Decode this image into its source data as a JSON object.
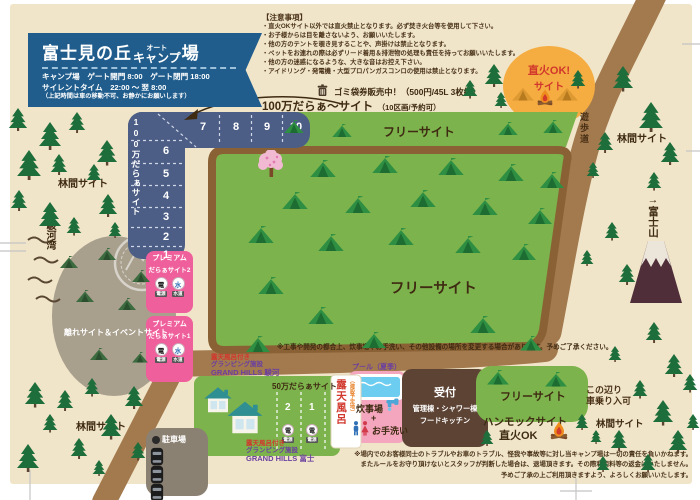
{
  "header": {
    "title_1": "富士見の丘",
    "title_2": "オート",
    "title_3": "キャンプ",
    "title_4": "場",
    "line1": "キャンプ場　ゲート開門 8:00　ゲート閉門 18:00",
    "line2": "サイレントタイム　22:00 ～ 翌 8:00",
    "line3": "（上記時間は車の移動不可、お静かにお願いします）"
  },
  "notice": {
    "heading": "【注意事項】",
    "items": [
      "・直火OKサイト以外では直火禁止となります。必ず焚き火台等を使用して下さい。",
      "・お子様からは目を離さないよう、お願いいたします。",
      "・他の方のテントを覗き見することや、声掛けは禁止となります。",
      "・ペットをお連れの際は必ずリード着用＆排泄物の処理も責任を持ってお願いいたします。",
      "・他の方の迷惑になるような、大きな音はお控え下さい。",
      "・アイドリング・発電機・大型プロパンガスコンロの使用は禁止となります。"
    ]
  },
  "garbage_sale": "ゴミ袋券販売中！（500円/45L 3枚組）",
  "million_site": {
    "label": "100万だらぁ～サイト",
    "note": "（10区画/予約可）",
    "strip_label": "100万だらぁサイト",
    "numbers_top": [
      "7",
      "8",
      "9",
      "10"
    ],
    "numbers_side": [
      "6",
      "5",
      "4",
      "3",
      "2",
      "1"
    ]
  },
  "labels": {
    "free_site": "フリーサイト",
    "rinkan_site": "林間サイト",
    "yuhodo": "遊歩道",
    "suruga_arrow": "←",
    "suruga": "駿河湾",
    "fuji": "→富士山",
    "hanare": "離れサイト＆イベントサイト",
    "parking": "駐車場"
  },
  "jikabi_site": {
    "line1": "直火OK!",
    "line2": "サイト"
  },
  "premium": {
    "title": "プレミアム",
    "site2": "だらぁサイト2",
    "site1": "だらぁサイト1",
    "power": "電源",
    "water": "水道",
    "power_kanji": "電",
    "water_kanji": "水"
  },
  "field_note": "※工事や開発の都合上、炊事場やお手洗い、その他設備の場所を変更する場合があります。予めご了承ください。",
  "glamping_suruga": {
    "l1": "露天風呂付き",
    "l2": "グランピング施設",
    "l3": "GRAND HILLS 駿河"
  },
  "glamping_fuji": {
    "l1": "露天風呂付き",
    "l2": "グランピング施設",
    "l3": "GRAND HILLS 富士"
  },
  "fifty_site": {
    "label": "50万だらぁサイト",
    "plot2": "2",
    "plot1": "1",
    "power": "電源",
    "power_kanji": "電"
  },
  "rotenburo": {
    "label": "露天風呂",
    "note": "（建設予定地）"
  },
  "pool_label": "プール（夏季）",
  "cooking": {
    "l1": "炊事場",
    "plus": "+",
    "l2": "お手洗い"
  },
  "reception": {
    "l1": "受付",
    "l2": "管理棟・シャワー棟",
    "l3": "フードキッチン"
  },
  "hammock": {
    "l1": "ハンモックサイト",
    "l2": "直火OK"
  },
  "car_entry": {
    "l1": "この辺り",
    "l2": "車乗り入可"
  },
  "disclaimer": [
    "※場内でのお客様同士のトラブルやお車のトラブル、怪我や事故等に対し当キャンプ場は一切の責任を負いかねます。",
    "またルールをお守り頂けないとスタッフが判断した場合は、退場頂きます。その際利用料等の返金はいたしません。",
    "予めご了承の上ご利用頂きますよう、よろしくお願いいたします。"
  ],
  "colors": {
    "paper": "#f0e5c9",
    "header_blue": "#205d8c",
    "strip_blue": "#4d5e86",
    "field_green": "#7cb34c",
    "fence_brown": "#8a6134",
    "path_brown": "#a3794e",
    "premium_pink": "#ef5f9b",
    "jikabi_yellow": "#f5ac40",
    "reception_brown": "#5c4334",
    "accent_red": "#d1372c"
  },
  "decor": {
    "pine": [
      [
        8,
        108,
        20
      ],
      [
        38,
        122,
        24
      ],
      [
        68,
        112,
        18
      ],
      [
        96,
        140,
        22
      ],
      [
        16,
        150,
        26
      ],
      [
        50,
        154,
        18
      ],
      [
        86,
        164,
        16
      ],
      [
        10,
        190,
        18
      ],
      [
        38,
        202,
        24
      ],
      [
        98,
        194,
        20
      ],
      [
        66,
        217,
        16
      ],
      [
        108,
        222,
        14
      ],
      [
        24,
        382,
        22
      ],
      [
        56,
        390,
        18
      ],
      [
        84,
        378,
        16
      ],
      [
        124,
        386,
        20
      ],
      [
        42,
        414,
        16
      ],
      [
        100,
        414,
        22
      ],
      [
        70,
        438,
        18
      ],
      [
        16,
        444,
        24
      ],
      [
        130,
        442,
        16
      ],
      [
        92,
        460,
        14
      ],
      [
        462,
        80,
        16
      ],
      [
        484,
        64,
        20
      ],
      [
        494,
        92,
        14
      ],
      [
        612,
        66,
        22
      ],
      [
        638,
        102,
        26
      ],
      [
        596,
        132,
        18
      ],
      [
        660,
        142,
        20
      ],
      [
        586,
        162,
        14
      ],
      [
        646,
        172,
        16
      ],
      [
        604,
        222,
        16
      ],
      [
        580,
        250,
        14
      ],
      [
        618,
        264,
        18
      ],
      [
        645,
        322,
        18
      ],
      [
        608,
        346,
        14
      ],
      [
        664,
        354,
        20
      ],
      [
        632,
        380,
        16
      ],
      [
        652,
        400,
        22
      ],
      [
        682,
        374,
        16
      ],
      [
        610,
        430,
        18
      ],
      [
        668,
        430,
        20
      ],
      [
        596,
        456,
        14
      ],
      [
        640,
        454,
        16
      ],
      [
        686,
        414,
        14
      ],
      [
        575,
        414,
        14
      ],
      [
        590,
        430,
        12
      ],
      [
        480,
        430,
        14
      ],
      [
        570,
        70,
        16
      ]
    ],
    "tent": [
      [
        310,
        160,
        26
      ],
      [
        372,
        156,
        26
      ],
      [
        438,
        158,
        26
      ],
      [
        498,
        164,
        26
      ],
      [
        540,
        172,
        24
      ],
      [
        282,
        192,
        26
      ],
      [
        345,
        196,
        26
      ],
      [
        410,
        190,
        26
      ],
      [
        472,
        198,
        26
      ],
      [
        528,
        208,
        24
      ],
      [
        248,
        226,
        26
      ],
      [
        318,
        234,
        26
      ],
      [
        388,
        228,
        26
      ],
      [
        455,
        236,
        26
      ],
      [
        512,
        244,
        24
      ],
      [
        258,
        277,
        26
      ],
      [
        308,
        307,
        26
      ],
      [
        362,
        332,
        24
      ],
      [
        470,
        316,
        26
      ],
      [
        520,
        336,
        22
      ],
      [
        246,
        336,
        24
      ],
      [
        284,
        120,
        20
      ],
      [
        332,
        124,
        20
      ],
      [
        498,
        122,
        20
      ],
      [
        543,
        120,
        20
      ],
      [
        487,
        370,
        22
      ],
      [
        545,
        372,
        22
      ]
    ],
    "tentD": [
      [
        60,
        256,
        18
      ],
      [
        98,
        248,
        18
      ],
      [
        132,
        270,
        18
      ],
      [
        76,
        290,
        18
      ],
      [
        118,
        298,
        18
      ],
      [
        90,
        348,
        18
      ],
      [
        132,
        352,
        16
      ]
    ],
    "tentO": [
      [
        512,
        86,
        22
      ],
      [
        556,
        86,
        22
      ]
    ],
    "fire": [
      [
        536,
        88,
        18
      ],
      [
        549,
        420,
        20
      ]
    ],
    "house": [
      [
        203,
        386,
        30
      ],
      [
        226,
        400,
        38
      ]
    ],
    "car": [
      [
        150,
        447,
        14
      ],
      [
        150,
        465,
        14
      ],
      [
        150,
        483,
        14
      ]
    ],
    "cherry": [
      [
        258,
        150,
        26
      ]
    ],
    "faucet": [
      [
        385,
        395,
        17
      ]
    ],
    "personM": [
      [
        352,
        421,
        8
      ]
    ],
    "personF": [
      [
        361,
        421,
        8
      ]
    ],
    "trash": [
      [
        317,
        84,
        11
      ]
    ]
  }
}
